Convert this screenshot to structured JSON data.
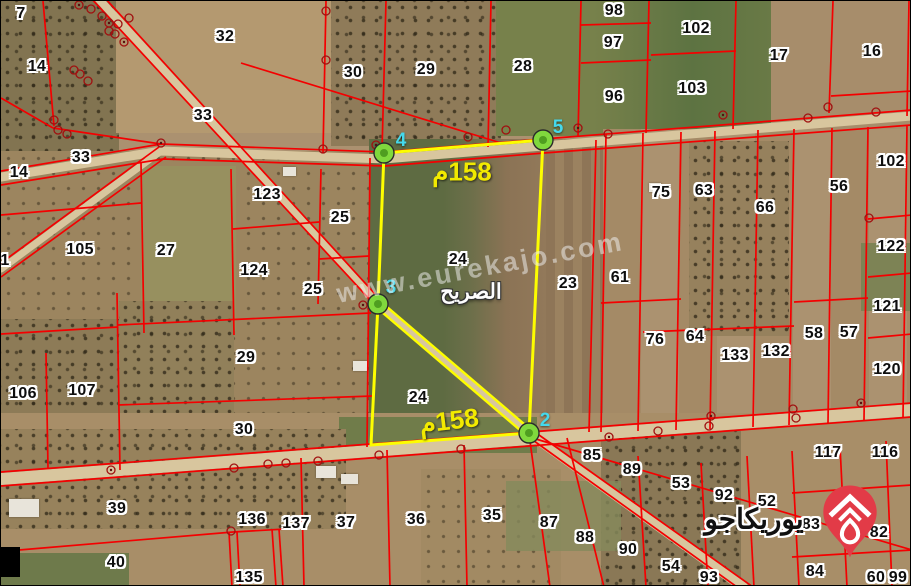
{
  "map": {
    "place_label": "الصريح",
    "watermark_text": "www.eurekajo.com",
    "logo_text": "يوريكاجو",
    "colors": {
      "parcel_boundary": "#f40000",
      "plot_outline": "#fdfd00",
      "vertex_fill": "#80d83d",
      "vertex_number": "#45d9ec",
      "area_label": "#f2ea00",
      "logo_pin": "#e23b47"
    },
    "area_labels": [
      {
        "text": "158م",
        "x": 461,
        "y": 171,
        "rot": 0
      },
      {
        "text": "158م",
        "x": 448,
        "y": 420,
        "rot": -7
      }
    ],
    "vertices": [
      {
        "label": "4",
        "x": 383,
        "y": 152,
        "lx": 400,
        "ly": 140
      },
      {
        "label": "5",
        "x": 542,
        "y": 139,
        "lx": 557,
        "ly": 127
      },
      {
        "label": "3",
        "x": 377,
        "y": 303,
        "lx": 390,
        "ly": 287
      },
      {
        "label": "2",
        "x": 528,
        "y": 432,
        "lx": 544,
        "ly": 420
      }
    ],
    "parcels": [
      {
        "label": "7",
        "x": 20,
        "y": 13
      },
      {
        "label": "32",
        "x": 224,
        "y": 36
      },
      {
        "label": "14",
        "x": 36,
        "y": 66
      },
      {
        "label": "33",
        "x": 202,
        "y": 115
      },
      {
        "label": "14",
        "x": 18,
        "y": 172
      },
      {
        "label": "33",
        "x": 80,
        "y": 157
      },
      {
        "label": "123",
        "x": 266,
        "y": 194
      },
      {
        "label": "25",
        "x": 339,
        "y": 217
      },
      {
        "label": "105",
        "x": 79,
        "y": 249
      },
      {
        "label": "27",
        "x": 165,
        "y": 250
      },
      {
        "label": "124",
        "x": 253,
        "y": 270
      },
      {
        "label": "25",
        "x": 312,
        "y": 289
      },
      {
        "label": "1",
        "x": 4,
        "y": 260
      },
      {
        "label": "30",
        "x": 352,
        "y": 72
      },
      {
        "label": "29",
        "x": 425,
        "y": 69
      },
      {
        "label": "28",
        "x": 522,
        "y": 66
      },
      {
        "label": "98",
        "x": 613,
        "y": 10
      },
      {
        "label": "97",
        "x": 612,
        "y": 42
      },
      {
        "label": "96",
        "x": 613,
        "y": 96
      },
      {
        "label": "102",
        "x": 695,
        "y": 28
      },
      {
        "label": "103",
        "x": 691,
        "y": 88
      },
      {
        "label": "17",
        "x": 778,
        "y": 55
      },
      {
        "label": "16",
        "x": 871,
        "y": 51
      },
      {
        "label": "102",
        "x": 890,
        "y": 161
      },
      {
        "label": "56",
        "x": 838,
        "y": 186
      },
      {
        "label": "75",
        "x": 660,
        "y": 192
      },
      {
        "label": "63",
        "x": 703,
        "y": 190
      },
      {
        "label": "66",
        "x": 764,
        "y": 207
      },
      {
        "label": "122",
        "x": 890,
        "y": 246
      },
      {
        "label": "61",
        "x": 619,
        "y": 277
      },
      {
        "label": "121",
        "x": 886,
        "y": 306
      },
      {
        "label": "24",
        "x": 457,
        "y": 259
      },
      {
        "label": "23",
        "x": 567,
        "y": 283
      },
      {
        "label": "58",
        "x": 813,
        "y": 333
      },
      {
        "label": "57",
        "x": 848,
        "y": 332
      },
      {
        "label": "76",
        "x": 654,
        "y": 339
      },
      {
        "label": "64",
        "x": 694,
        "y": 336
      },
      {
        "label": "133",
        "x": 734,
        "y": 355
      },
      {
        "label": "132",
        "x": 775,
        "y": 351
      },
      {
        "label": "120",
        "x": 886,
        "y": 369
      },
      {
        "label": "29",
        "x": 245,
        "y": 357
      },
      {
        "label": "106",
        "x": 22,
        "y": 393
      },
      {
        "label": "107",
        "x": 81,
        "y": 390
      },
      {
        "label": "24",
        "x": 417,
        "y": 397
      },
      {
        "label": "30",
        "x": 243,
        "y": 429
      },
      {
        "label": "117",
        "x": 827,
        "y": 452
      },
      {
        "label": "116",
        "x": 884,
        "y": 452
      },
      {
        "label": "85",
        "x": 591,
        "y": 455
      },
      {
        "label": "89",
        "x": 631,
        "y": 469
      },
      {
        "label": "39",
        "x": 116,
        "y": 508
      },
      {
        "label": "136",
        "x": 251,
        "y": 519
      },
      {
        "label": "137",
        "x": 295,
        "y": 523
      },
      {
        "label": "37",
        "x": 345,
        "y": 522
      },
      {
        "label": "36",
        "x": 415,
        "y": 519
      },
      {
        "label": "35",
        "x": 491,
        "y": 515
      },
      {
        "label": "87",
        "x": 548,
        "y": 522
      },
      {
        "label": "53",
        "x": 680,
        "y": 483
      },
      {
        "label": "92",
        "x": 723,
        "y": 495
      },
      {
        "label": "52",
        "x": 766,
        "y": 501
      },
      {
        "label": "83",
        "x": 810,
        "y": 524
      },
      {
        "label": "88",
        "x": 584,
        "y": 537
      },
      {
        "label": "82",
        "x": 878,
        "y": 532
      },
      {
        "label": "90",
        "x": 627,
        "y": 549
      },
      {
        "label": "40",
        "x": 115,
        "y": 562
      },
      {
        "label": "54",
        "x": 670,
        "y": 566
      },
      {
        "label": "135",
        "x": 248,
        "y": 577
      },
      {
        "label": "93",
        "x": 708,
        "y": 577
      },
      {
        "label": "84",
        "x": 814,
        "y": 571
      },
      {
        "label": "60",
        "x": 875,
        "y": 577
      },
      {
        "label": "99",
        "x": 897,
        "y": 577
      }
    ]
  }
}
